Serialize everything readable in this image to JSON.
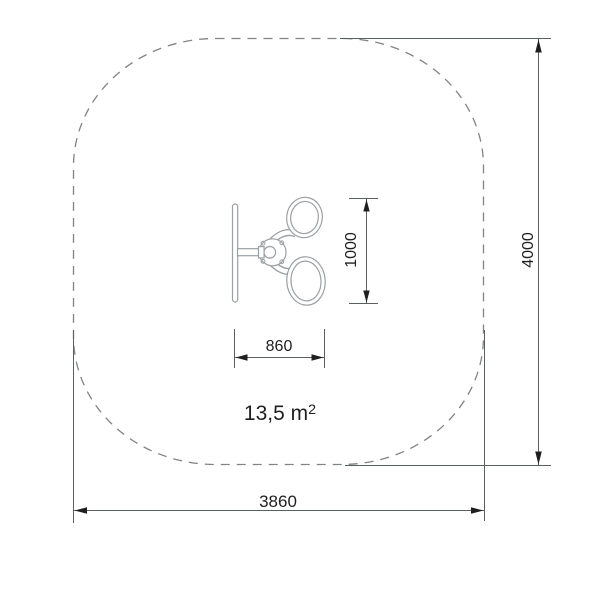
{
  "drawing": {
    "type": "technical-plan-top-view",
    "area_label": {
      "text": "13,5 m",
      "sup": "2"
    },
    "dimensions": {
      "safety_zone_height": "4000",
      "safety_zone_width": "3860",
      "equipment_span": "1000",
      "equipment_width": "860"
    },
    "colors": {
      "background": "#ffffff",
      "safety_zone_dash": "#7f8487",
      "dimension_line": "#5a5f62",
      "arrow_and_text": "#1f1f1f",
      "equipment_line": "#9aa0a4"
    }
  }
}
